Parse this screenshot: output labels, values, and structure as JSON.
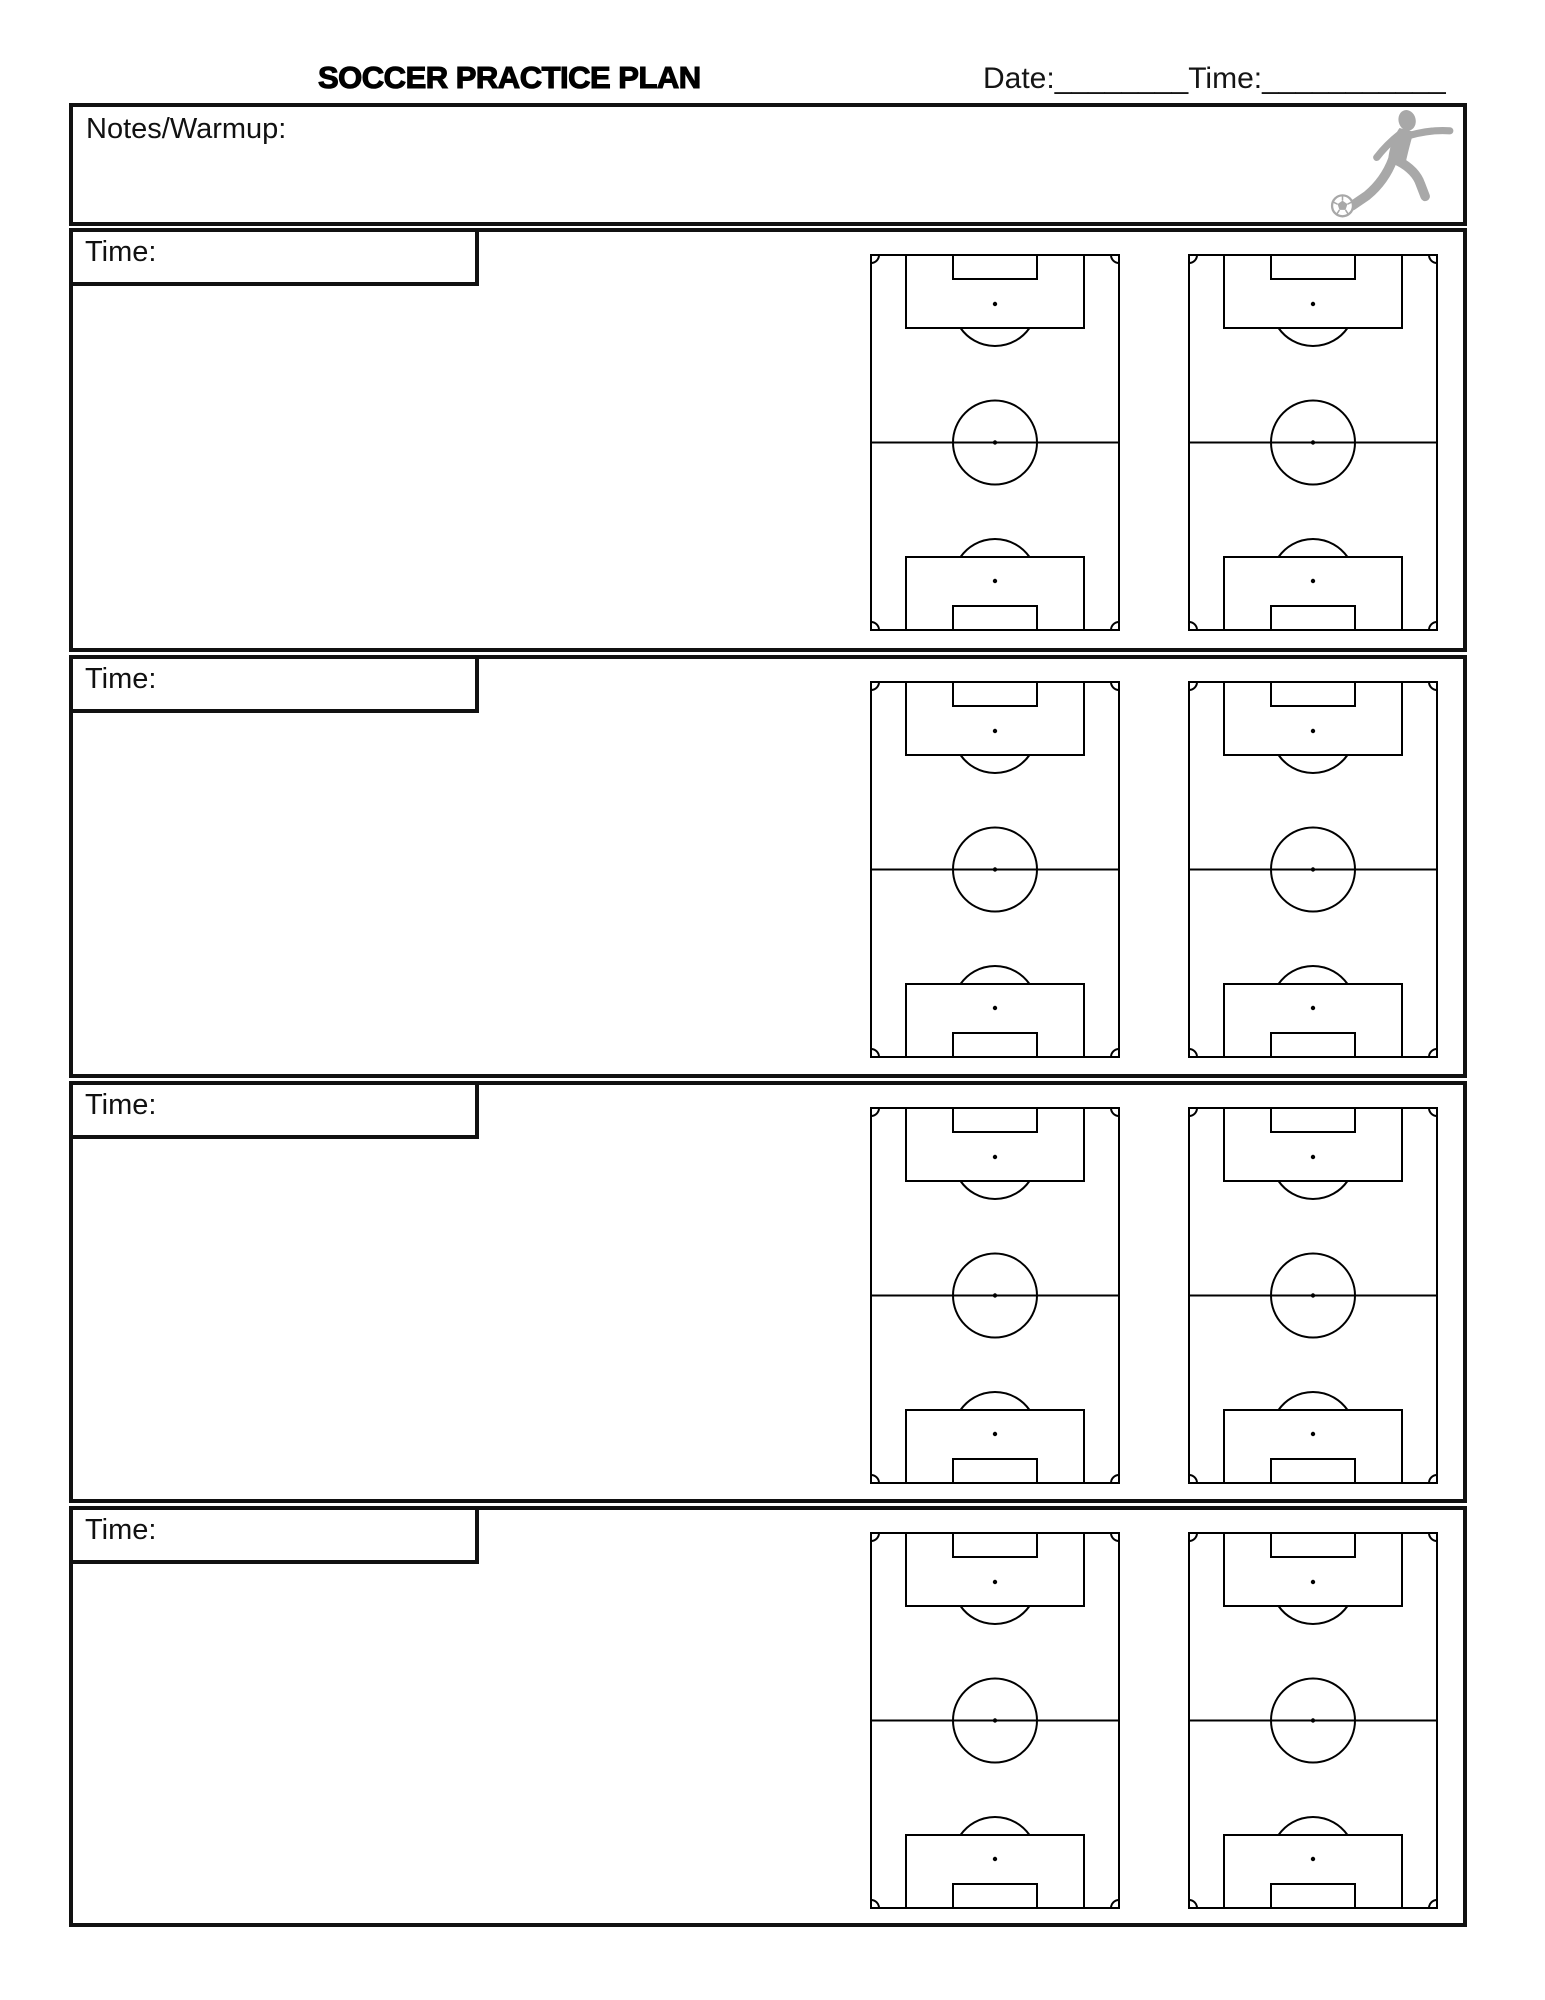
{
  "header": {
    "title": "SOCCER PRACTICE PLAN",
    "date_label": "Date:",
    "date_blank": "________",
    "time_label": "Time:",
    "time_blank": "___________"
  },
  "notes": {
    "label": "Notes/Warmup:"
  },
  "sections": [
    {
      "time_label": "Time:"
    },
    {
      "time_label": "Time:"
    },
    {
      "time_label": "Time:"
    },
    {
      "time_label": "Time:"
    }
  ],
  "icons": {
    "player": "soccer-player-kicking-ball-icon",
    "ball": "soccer-ball-icon",
    "field": "soccer-field-diagram"
  },
  "colors": {
    "line": "#111111",
    "field_line": "#000000",
    "icon_gray": "#a8a8a8",
    "background": "#ffffff"
  }
}
